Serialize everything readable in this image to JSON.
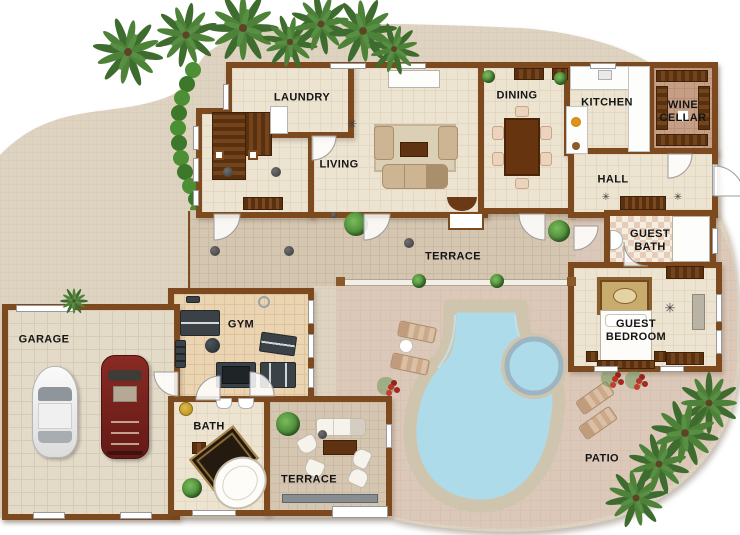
{
  "plan": {
    "labels": {
      "laundry": "LAUNDRY",
      "living": "LIVING",
      "dining": "DINING",
      "kitchen": "KITCHEN",
      "wine_cellar": "WINE CELLAR",
      "hall": "HALL",
      "guest_bath": "GUEST BATH",
      "guest_bedroom": "GUEST BEDROOM",
      "terrace": "TERRACE",
      "gym": "GYM",
      "garage": "GARAGE",
      "bath": "BATH",
      "terrace_lower": "TERRACE",
      "patio": "PATIO"
    },
    "icons": {
      "ceiling_fan": "✳"
    },
    "colors": {
      "wall": "#7c4a1e",
      "interior_floor": "#ece3d1",
      "terrace_floor": "#d5c6b2",
      "patio_paving": "#dbc8b8",
      "driveway_paving": "#ded3c1",
      "pool_water": "#aedbe9",
      "pool_stone": "#cfc5ae",
      "spa_ring": "#9db4c3",
      "palm_green": "#4d8238",
      "hedge_green": "#4c8f35",
      "wood_dark": "#5f3311",
      "gym_equipment": "#3b4247",
      "car_red": "#7e2220",
      "car_white": "#f5f5f5",
      "label_text": "#141414"
    }
  }
}
